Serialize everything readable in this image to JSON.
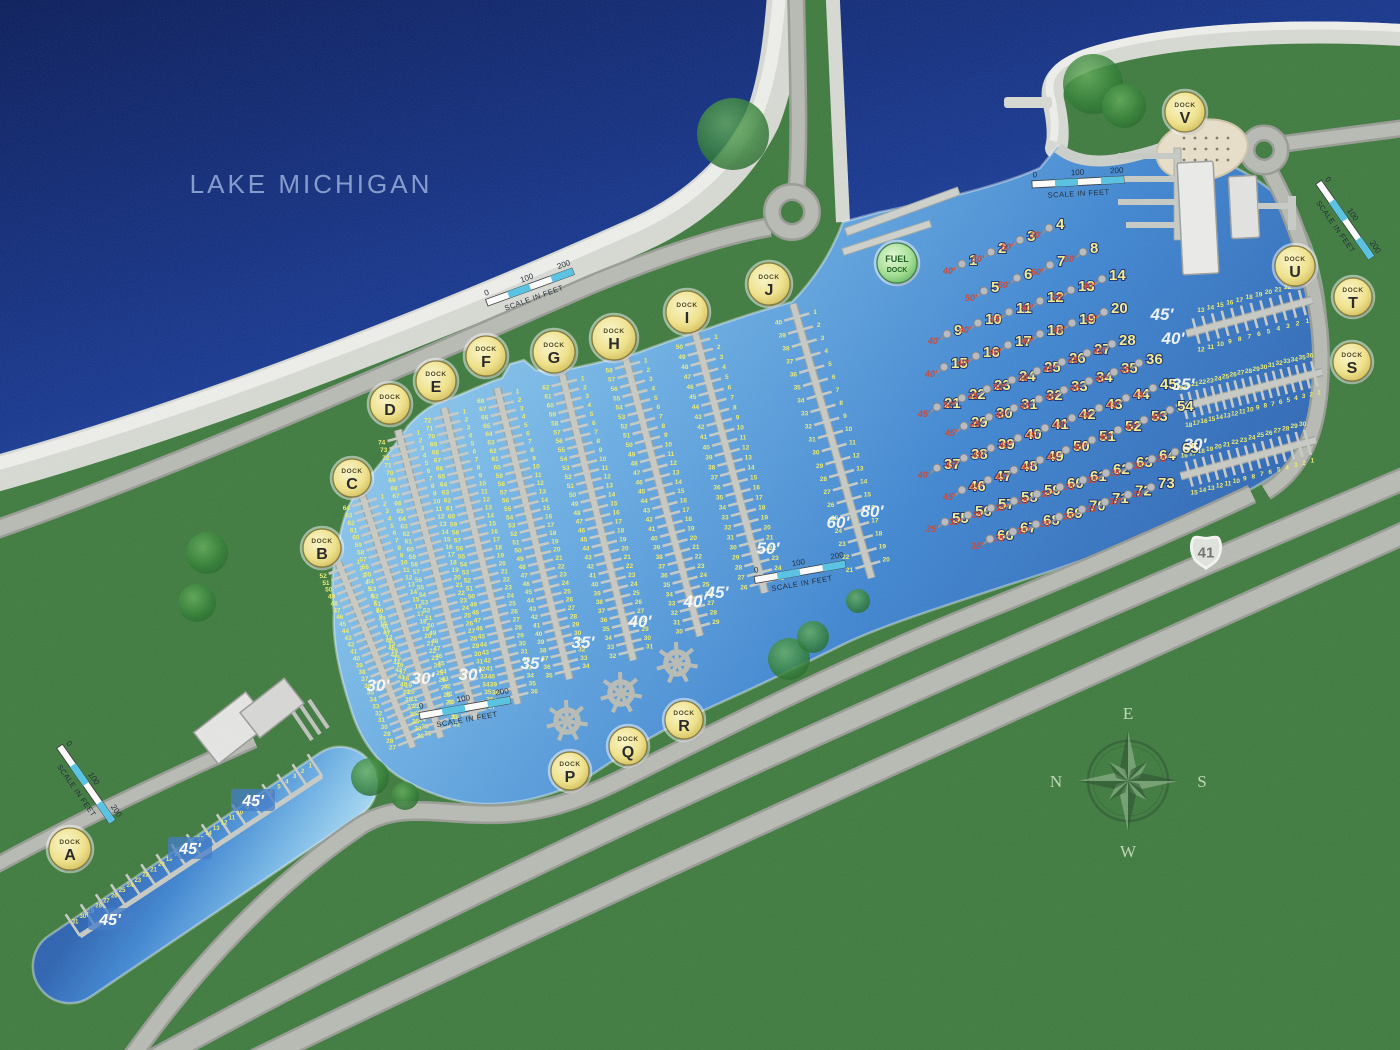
{
  "lake_label": "LAKE MICHIGAN",
  "highway_shield": "41",
  "badge_word": "DOCK",
  "fuel_badge": {
    "line1": "FUEL",
    "line2": "DOCK",
    "x": 897,
    "y": 263
  },
  "dock_badges": [
    {
      "letter": "A",
      "x": 70,
      "y": 849,
      "r": 21
    },
    {
      "letter": "B",
      "x": 322,
      "y": 548,
      "r": 19
    },
    {
      "letter": "C",
      "x": 352,
      "y": 478,
      "r": 19
    },
    {
      "letter": "D",
      "x": 390,
      "y": 404,
      "r": 20
    },
    {
      "letter": "E",
      "x": 436,
      "y": 381,
      "r": 20
    },
    {
      "letter": "F",
      "x": 486,
      "y": 356,
      "r": 20
    },
    {
      "letter": "G",
      "x": 554,
      "y": 352,
      "r": 21
    },
    {
      "letter": "H",
      "x": 614,
      "y": 338,
      "r": 22
    },
    {
      "letter": "I",
      "x": 687,
      "y": 312,
      "r": 21
    },
    {
      "letter": "J",
      "x": 769,
      "y": 284,
      "r": 21
    },
    {
      "letter": "P",
      "x": 570,
      "y": 771,
      "r": 19
    },
    {
      "letter": "Q",
      "x": 628,
      "y": 746,
      "r": 19
    },
    {
      "letter": "R",
      "x": 684,
      "y": 720,
      "r": 19
    },
    {
      "letter": "S",
      "x": 1352,
      "y": 362,
      "r": 19
    },
    {
      "letter": "T",
      "x": 1353,
      "y": 297,
      "r": 19
    },
    {
      "letter": "U",
      "x": 1295,
      "y": 266,
      "r": 20
    },
    {
      "letter": "V",
      "x": 1185,
      "y": 112,
      "r": 20
    }
  ],
  "piers": {
    "main": [
      {
        "letter": "B",
        "x": 338,
        "y": 562,
        "tilt": 22,
        "len": 200,
        "slips": 52
      },
      {
        "letter": "C",
        "x": 362,
        "y": 495,
        "tilt": 18,
        "len": 255,
        "slips": 64
      },
      {
        "letter": "D",
        "x": 398,
        "y": 430,
        "tilt": 15,
        "len": 300,
        "slips": 74
      },
      {
        "letter": "E",
        "x": 444,
        "y": 408,
        "tilt": 14,
        "len": 305,
        "slips": 72
      },
      {
        "letter": "F",
        "x": 497,
        "y": 388,
        "tilt": 14,
        "len": 300,
        "slips": 68
      },
      {
        "letter": "G",
        "x": 562,
        "y": 374,
        "tilt": 14,
        "len": 295,
        "slips": 62
      },
      {
        "letter": "H",
        "x": 625,
        "y": 356,
        "tilt": 15,
        "len": 290,
        "slips": 58
      },
      {
        "letter": "I",
        "x": 695,
        "y": 332,
        "tilt": 15,
        "len": 270,
        "slips": 50
      },
      {
        "letter": "J",
        "x": 793,
        "y": 304,
        "tilt": 16,
        "len": 285,
        "slips": 40
      }
    ],
    "east": [
      {
        "letter": "U",
        "x": 1312,
        "y": 300,
        "rot": -75,
        "len": 130,
        "slips": 23
      },
      {
        "letter": "T",
        "x": 1322,
        "y": 372,
        "rot": -76,
        "len": 150,
        "slips": 36
      },
      {
        "letter": "S",
        "x": 1316,
        "y": 440,
        "rot": -75,
        "len": 140,
        "slips": 30
      }
    ],
    "dockA": {
      "x1": 322,
      "y1": 776,
      "x2": 80,
      "y2": 936,
      "slips": 31,
      "fingers": 16
    }
  },
  "star_docks": [
    [
      567,
      721
    ],
    [
      621,
      693
    ],
    [
      677,
      663
    ]
  ],
  "moorings": {
    "rows": [
      {
        "start": 1,
        "count": 4,
        "x": 962,
        "y": 264,
        "dx": 29,
        "dy": -12,
        "sizes": [
          "40'",
          "50'",
          "50'",
          "50'"
        ]
      },
      {
        "start": 5,
        "count": 4,
        "x": 984,
        "y": 291,
        "dx": 33,
        "dy": -13,
        "sizes": [
          "50'",
          "60'",
          "60'",
          "50'"
        ]
      },
      {
        "start": 9,
        "count": 6,
        "x": 947,
        "y": 334,
        "dx": 31,
        "dy": -11,
        "sizes": [
          "40'",
          "40'",
          "45'",
          "40'",
          "40'",
          "40'"
        ]
      },
      {
        "start": 15,
        "count": 6,
        "x": 944,
        "y": 367,
        "dx": 32,
        "dy": -11,
        "sizes": [
          "40'",
          "40'",
          "40'",
          "40'",
          "45'",
          "45'"
        ]
      },
      {
        "start": 21,
        "count": 8,
        "x": 937,
        "y": 407,
        "dx": 25,
        "dy": -9,
        "sizes": [
          "45'",
          "50'",
          "45'",
          "50'",
          "50'",
          "45'",
          "45'",
          "45'"
        ]
      },
      {
        "start": 29,
        "count": 8,
        "x": 964,
        "y": 426,
        "dx": 25,
        "dy": -9,
        "sizes": [
          "45'",
          "45'",
          "45'",
          "45'",
          "45'",
          "45'",
          "45'",
          "45'"
        ]
      },
      {
        "start": 37,
        "count": 9,
        "x": 937,
        "y": 468,
        "dx": 27,
        "dy": -10,
        "sizes": [
          "40'",
          "45'",
          "45'",
          "40'",
          "45'",
          "45'",
          "40'",
          "45'",
          "45'"
        ]
      },
      {
        "start": 46,
        "count": 9,
        "x": 962,
        "y": 490,
        "dx": 26,
        "dy": -10,
        "sizes": [
          "45'",
          "45'",
          "45'",
          "45'",
          "45'",
          "45'",
          "45'",
          "45'",
          "45'"
        ]
      },
      {
        "start": 55,
        "count": 11,
        "x": 945,
        "y": 522,
        "dx": 23,
        "dy": -7,
        "sizes": [
          "35'",
          "35'",
          "35'",
          "35'",
          "35'",
          "35'",
          "35'",
          "35'",
          "35'",
          "35'",
          "35'"
        ]
      },
      {
        "start": 66,
        "count": 8,
        "x": 990,
        "y": 539,
        "dx": 23,
        "dy": -7.4,
        "sizes": [
          "35'",
          "35'",
          "35'",
          "35'",
          "35'",
          "35'",
          "35'",
          "35'"
        ]
      }
    ]
  },
  "depth_labels": [
    {
      "t": "30'",
      "x": 378,
      "y": 691
    },
    {
      "t": "30'",
      "x": 423,
      "y": 684
    },
    {
      "t": "30'",
      "x": 470,
      "y": 680
    },
    {
      "t": "35'",
      "x": 532,
      "y": 669
    },
    {
      "t": "35'",
      "x": 583,
      "y": 648
    },
    {
      "t": "40'",
      "x": 640,
      "y": 627
    },
    {
      "t": "40'",
      "x": 695,
      "y": 607
    },
    {
      "t": "45'",
      "x": 717,
      "y": 598
    },
    {
      "t": "50'",
      "x": 768,
      "y": 554
    },
    {
      "t": "60'",
      "x": 838,
      "y": 528
    },
    {
      "t": "80'",
      "x": 872,
      "y": 517
    },
    {
      "t": "45'",
      "x": 1162,
      "y": 320
    },
    {
      "t": "40'",
      "x": 1173,
      "y": 344
    },
    {
      "t": "35'",
      "x": 1183,
      "y": 390
    },
    {
      "t": "30'",
      "x": 1195,
      "y": 450
    }
  ],
  "boxed_depth_labels": [
    {
      "t": "45'",
      "x": 253,
      "y": 804
    },
    {
      "t": "45'",
      "x": 190,
      "y": 852
    },
    {
      "t": "45'",
      "x": 110,
      "y": 923
    }
  ],
  "scale_bar": {
    "ticks": [
      "0",
      "100",
      "200"
    ],
    "caption": "SCALE IN FEET",
    "positions": [
      {
        "x": 530,
        "y": 287,
        "a": -20
      },
      {
        "x": 1078,
        "y": 182,
        "a": -3
      },
      {
        "x": 1345,
        "y": 220,
        "a": 55
      },
      {
        "x": 800,
        "y": 572,
        "a": -10
      },
      {
        "x": 465,
        "y": 708,
        "a": -10
      },
      {
        "x": 86,
        "y": 784,
        "a": 55
      }
    ]
  },
  "compass": {
    "x": 1128,
    "y": 781,
    "letters": {
      "top": "E",
      "right": "S",
      "bottom": "W",
      "left": "N"
    }
  },
  "colors": {
    "slip_number": "#f0ee6e",
    "mooring_number": "#f5ef8e",
    "mooring_size": "#c94434",
    "depth_text": "#ffffff",
    "badge_stroke": "#8a7a35",
    "pier": "#c8cbc5"
  }
}
